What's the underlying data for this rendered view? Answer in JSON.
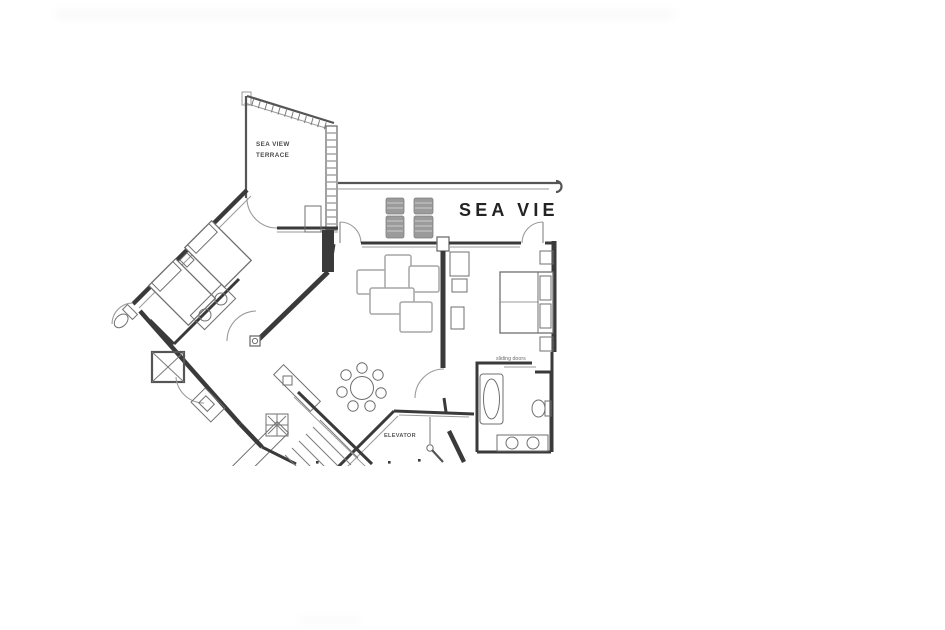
{
  "plan": {
    "banner_text": "SEA VIE",
    "terrace_label_line1": "SEA VIEW",
    "terrace_label_line2": "TERRACE",
    "sliding_doors_label": "sliding doors",
    "elevator_label": "ELEVATOR"
  },
  "colors": {
    "background": "#ffffff",
    "wall": "#3a3a3a",
    "wall_light": "#9a9a9a",
    "furniture": "#6f6f6f",
    "sofa_outline": "#a6a6a6",
    "lounger_fill": "#9b9b9b",
    "label_text": "#4a4a4a",
    "banner_text": "#232323"
  }
}
